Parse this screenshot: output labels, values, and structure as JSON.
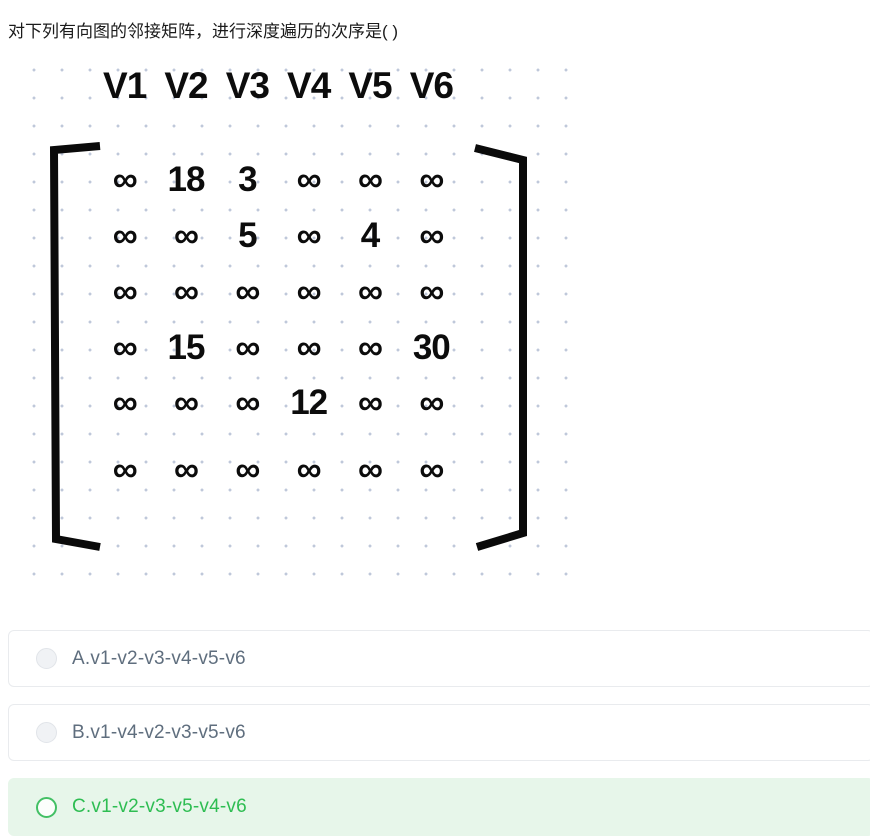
{
  "question": {
    "title": "对下列有向图的邻接矩阵，进行深度遍历的次序是( )"
  },
  "matrix_figure": {
    "description": "adjacency-matrix",
    "header": [
      "V1",
      "V2",
      "V3",
      "V4",
      "V5",
      "V6"
    ],
    "rows": [
      [
        "∞",
        "18",
        "3",
        "∞",
        "∞",
        "∞"
      ],
      [
        "∞",
        "∞",
        "5",
        "∞",
        "4",
        "∞"
      ],
      [
        "∞",
        "∞",
        "∞",
        "∞",
        "∞",
        "∞"
      ],
      [
        "∞",
        "15",
        "∞",
        "∞",
        "∞",
        "30"
      ],
      [
        "∞",
        "∞",
        "∞",
        "12",
        "∞",
        "∞"
      ],
      [
        "∞",
        "∞",
        "∞",
        "∞",
        "∞",
        "∞"
      ]
    ]
  },
  "options": [
    {
      "id": "A",
      "label": "A.v1-v2-v3-v4-v5-v6",
      "state": "default"
    },
    {
      "id": "B",
      "label": "B.v1-v4-v2-v3-v5-v6",
      "state": "default"
    },
    {
      "id": "C",
      "label": "C.v1-v2-v3-v5-v4-v6",
      "state": "correct"
    }
  ],
  "colors": {
    "correct_text": "#2ebd52",
    "correct_bg": "#e7f6ea",
    "correct_radio_border": "#43c065",
    "option_text": "#5f6e7e",
    "card_border": "#e9ebee",
    "dot_grid": "#bfc8da",
    "matrix_ink": "#0c0c0c"
  }
}
